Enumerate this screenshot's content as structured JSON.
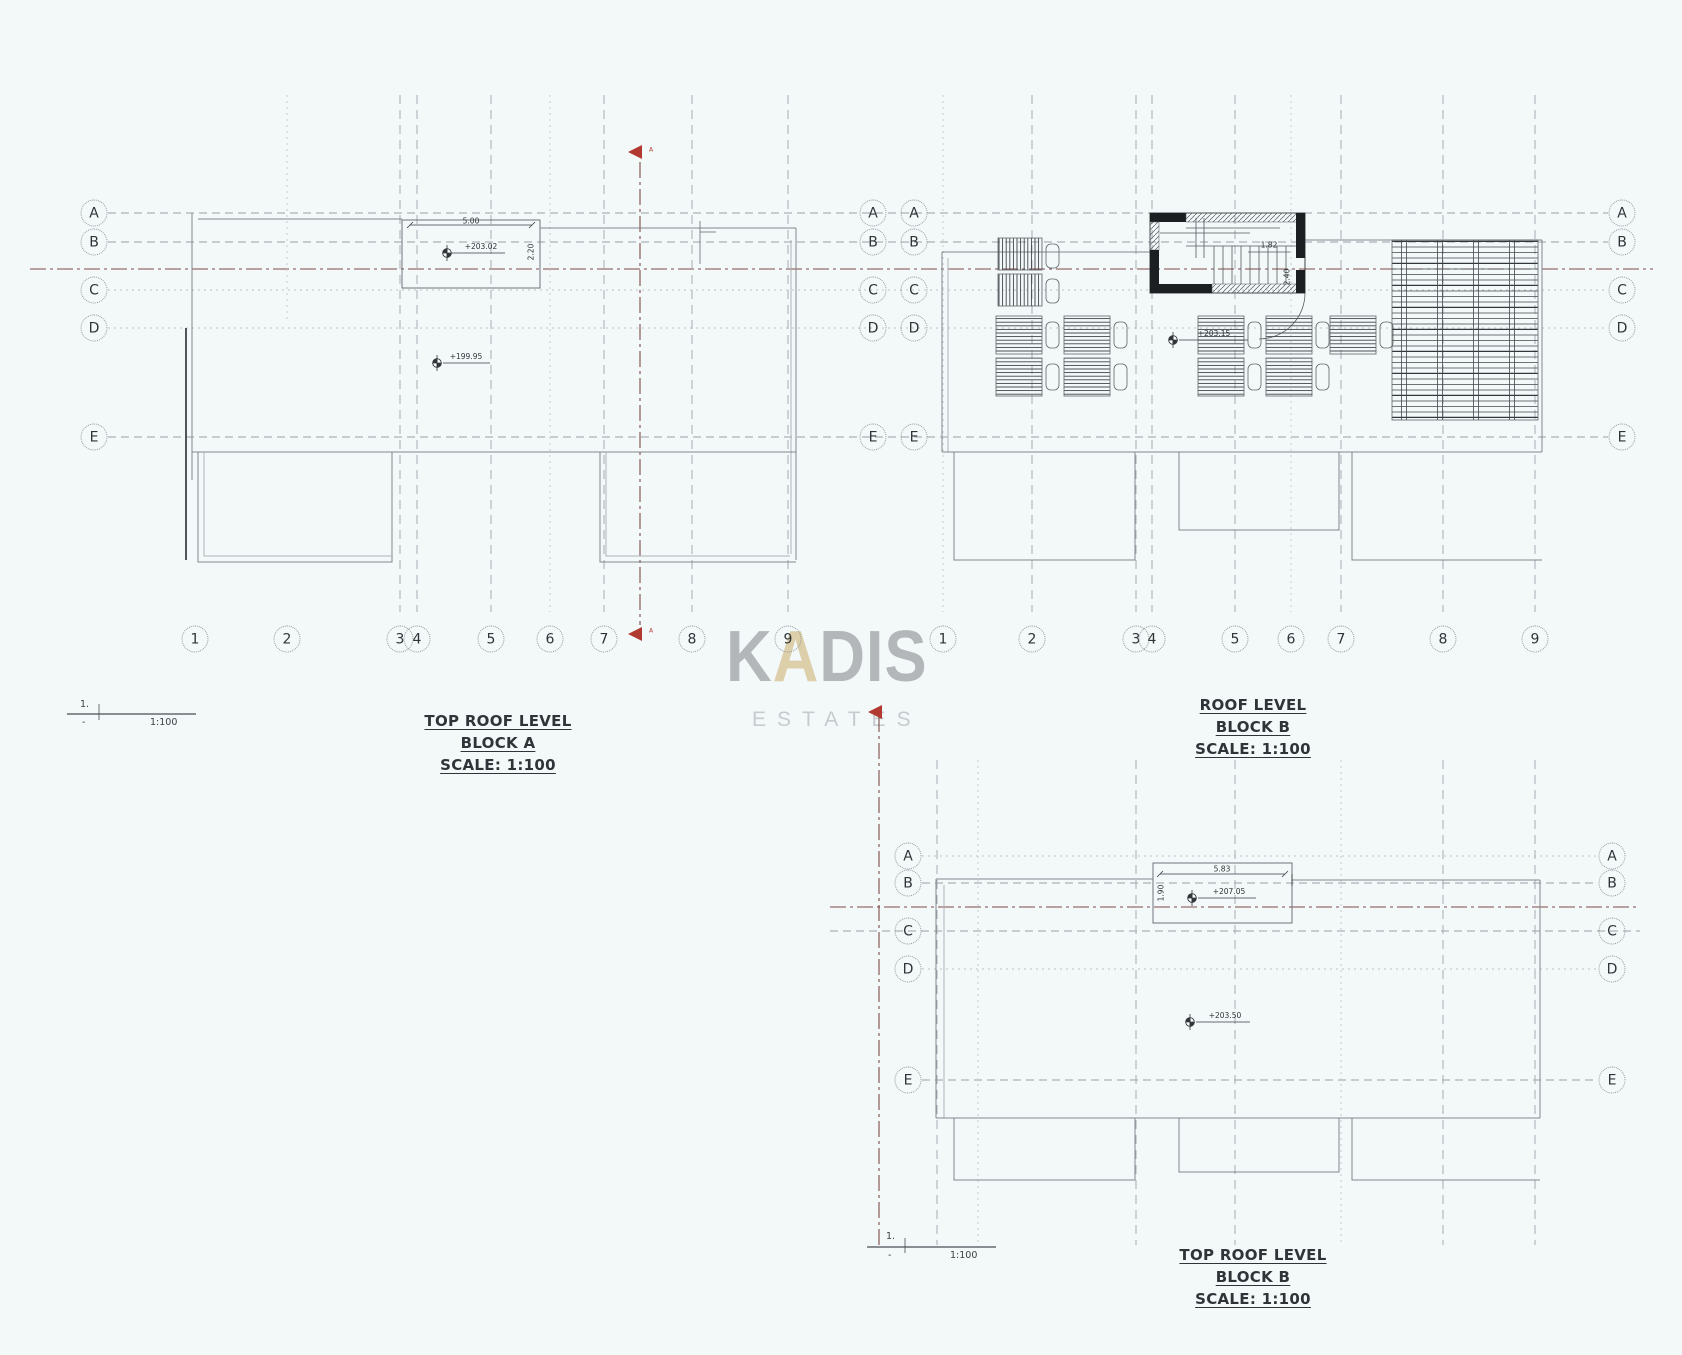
{
  "sheet": {
    "background": "#f3f8f9",
    "grid_line_color": "#9aa1a7",
    "section_line_color": "#7d4a46",
    "section_marker_color": "#b03a30"
  },
  "watermark": {
    "brand_first": "K",
    "brand_accent": "A",
    "brand_rest": "DIS",
    "subtitle": "ESTATES",
    "brand_color": "#b4b7ba",
    "accent_color": "#ddcfa9",
    "subtitle_color": "#c7cbcf"
  },
  "plans": {
    "block_a_top_roof": {
      "title_lines": [
        "TOP ROOF LEVEL",
        "BLOCK A",
        "SCALE: 1:100"
      ],
      "row_labels": [
        "A",
        "B",
        "C",
        "D",
        "E"
      ],
      "col_labels": [
        "1",
        "2",
        "3",
        "4",
        "5",
        "6",
        "7",
        "8",
        "9"
      ],
      "stair_width_dim": "5.00",
      "stair_depth_dim": "2.20",
      "level_roof_top": "+203.02",
      "level_roof": "+199.95",
      "section_label": "A",
      "scale_bar": {
        "numerator": "1.",
        "denominator": "-",
        "ratio": "1:100"
      }
    },
    "block_b_roof": {
      "title_lines": [
        "ROOF LEVEL",
        "BLOCK B",
        "SCALE: 1:100"
      ],
      "row_labels": [
        "A",
        "B",
        "C",
        "D",
        "E"
      ],
      "col_labels": [
        "1",
        "2",
        "3",
        "4",
        "5",
        "6",
        "7",
        "8",
        "9"
      ],
      "stair_width_dim": "1.82",
      "stair_depth_dim": "2.40",
      "level_roof": "+203.15"
    },
    "block_b_top_roof": {
      "title_lines": [
        "TOP ROOF LEVEL",
        "BLOCK B",
        "SCALE: 1:100"
      ],
      "row_labels": [
        "A",
        "B",
        "C",
        "D",
        "E"
      ],
      "stair_width_dim": "5.83",
      "stair_depth_dim": "1.90",
      "level_roof_top": "+207.05",
      "level_roof": "+203.50",
      "scale_bar": {
        "numerator": "1.",
        "denominator": "-",
        "ratio": "1:100"
      }
    }
  }
}
